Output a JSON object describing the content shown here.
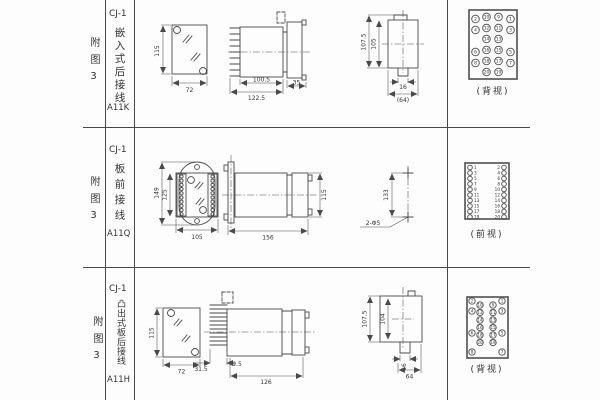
{
  "colors": {
    "line": "#4a4a4a",
    "text": "#3a3a3a",
    "background": "#fdfdfd"
  },
  "rows": [
    {
      "fig": "附图3",
      "model": "CJ-1",
      "mount": "嵌入式后接线",
      "code": "A11K",
      "view_label": "(背视)",
      "panel": {
        "h": "115",
        "w": "72"
      },
      "side": {
        "body": "100.5",
        "total": "122.5",
        "flange": "35"
      },
      "rear": {
        "outer": "107.5",
        "inner": "105",
        "stem": "16",
        "base": "(64)"
      },
      "terminals": {
        "grid": [
          [
            "2",
            "10",
            "9",
            "1"
          ],
          [
            "4",
            "12",
            "11",
            "3"
          ],
          [
            "",
            "14",
            "13",
            ""
          ],
          [
            "6",
            "16",
            "15",
            "5"
          ],
          [
            "8",
            "18",
            "17",
            "7"
          ],
          [
            "",
            "20",
            "19",
            ""
          ]
        ]
      }
    },
    {
      "fig": "附图3",
      "model": "CJ-1",
      "mount": "板前接线",
      "code": "A11Q",
      "view_label": "(前视)",
      "front": {
        "outer": "149",
        "inner": "125",
        "w": "105"
      },
      "side": {
        "total": "156",
        "h": "115"
      },
      "holes": {
        "span": "133",
        "label": "2-Φ5"
      },
      "terminals": {
        "left": [
          "1",
          "3",
          "5",
          "7",
          "9",
          "11",
          "13",
          "15",
          "17",
          "19"
        ],
        "right": [
          "2",
          "4",
          "6",
          "8",
          "10",
          "12",
          "14",
          "16",
          "18",
          "20"
        ]
      }
    },
    {
      "fig": "附图3",
      "model": "CJ-1",
      "mount": "凸出式板后接线",
      "code": "A11H",
      "view_label": "(背视)",
      "panel": {
        "h": "115",
        "w": "72"
      },
      "side": {
        "pins": "31.5",
        "gap": "9.5",
        "body": "126"
      },
      "rear": {
        "outer": "107.5",
        "inner": "104",
        "stem": "16",
        "base": "64"
      },
      "terminals": {
        "outer_left": [
          "2",
          "4",
          "6",
          "8"
        ],
        "inner_left": [
          "10",
          "12",
          "14",
          "16",
          "18",
          "20"
        ],
        "inner_right": [
          "9",
          "11",
          "13",
          "15",
          "17",
          "19"
        ],
        "outer_right": [
          "1",
          "3",
          "5",
          "7"
        ]
      }
    }
  ]
}
